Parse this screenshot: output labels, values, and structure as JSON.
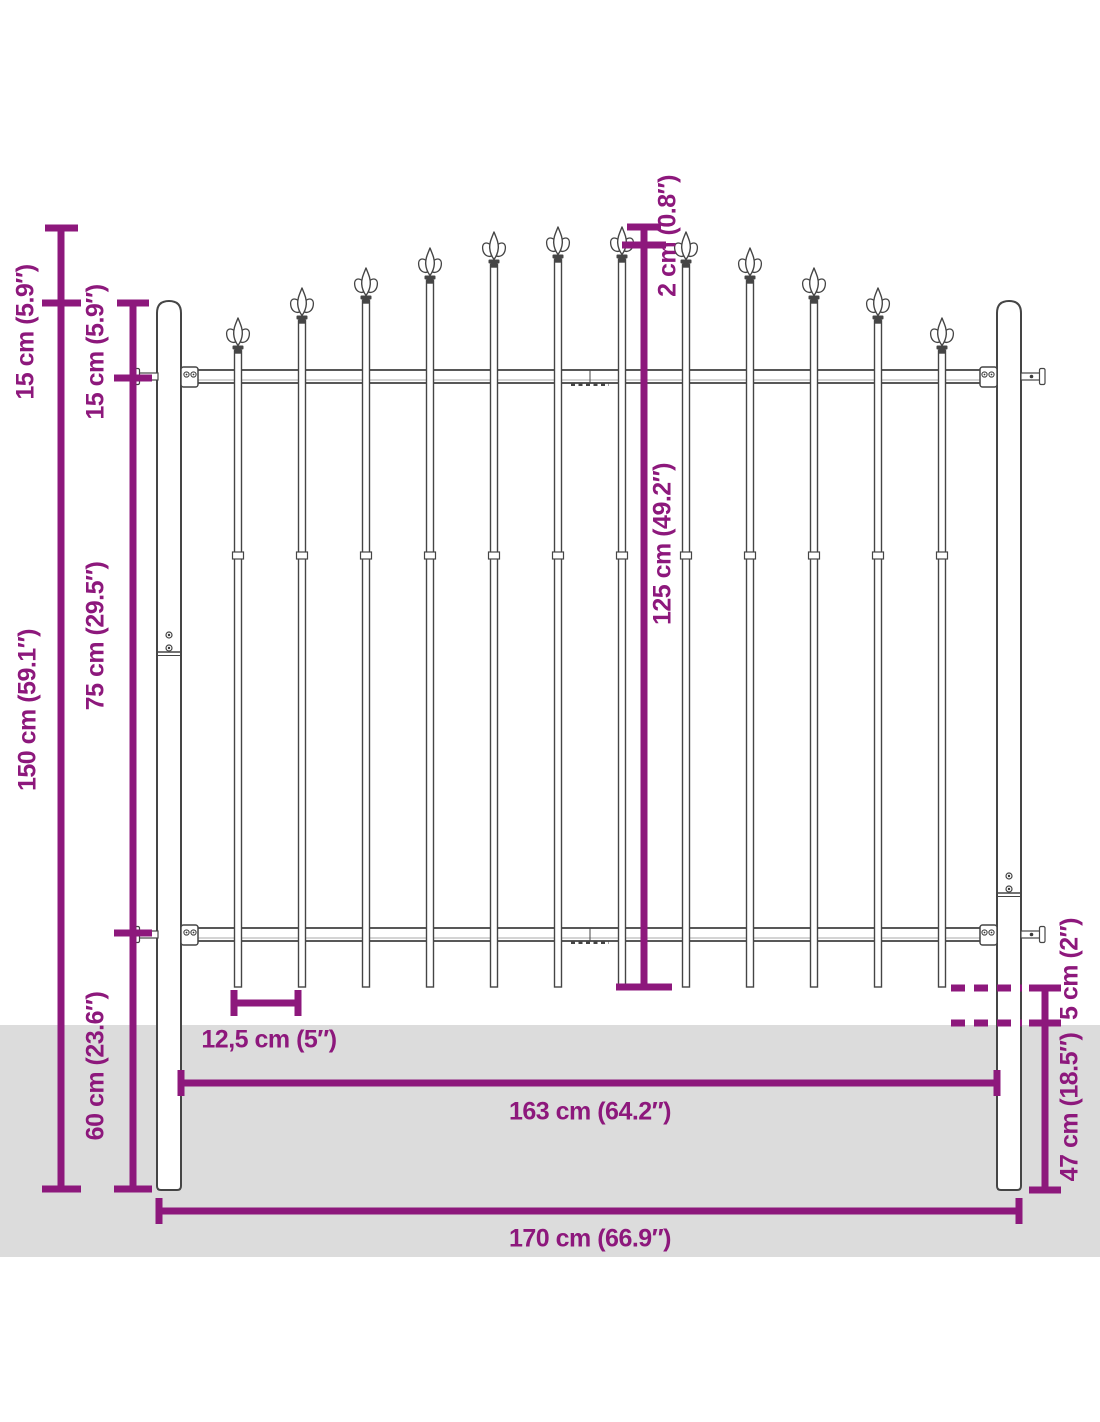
{
  "colors": {
    "dimension": "#8D187C",
    "fence_outline": "#454545",
    "fence_fill": "#ffffff",
    "rail_shade": "#aaaaaa",
    "screw_dot": "#3a3a3a",
    "ground": "#dcdcdc",
    "background": "#ffffff"
  },
  "dimensions": {
    "left_outer_15": "15 cm (5.9″)",
    "left_inner_15": "15 cm (5.9″)",
    "left_inner_75": "75 cm (29.5″)",
    "left_outer_150": "150 cm (59.1″)",
    "left_inner_60": "60 cm (23.6″)",
    "center_2": "2 cm (0.8″)",
    "center_125": "125 cm (49.2″)",
    "right_5": "5 cm (2″)",
    "right_47": "47 cm (18.5″)",
    "spacing": "12,5 cm (5″)",
    "width_inner": "163 cm (64.2″)",
    "width_outer": "170 cm (66.9″)"
  },
  "layout": {
    "labels": [
      {
        "key": "left_outer_15",
        "x": 26,
        "y": 332,
        "rot": -90
      },
      {
        "key": "left_inner_15",
        "x": 96,
        "y": 352,
        "rot": -90
      },
      {
        "key": "left_inner_75",
        "x": 96,
        "y": 636,
        "rot": -90
      },
      {
        "key": "left_outer_150",
        "x": 28,
        "y": 710,
        "rot": -90
      },
      {
        "key": "left_inner_60",
        "x": 96,
        "y": 1066,
        "rot": -90
      },
      {
        "key": "center_2",
        "x": 668,
        "y": 236,
        "rot": -90
      },
      {
        "key": "center_125",
        "x": 663,
        "y": 544,
        "rot": -90
      },
      {
        "key": "right_5",
        "x": 1070,
        "y": 969,
        "rot": -90
      },
      {
        "key": "right_47",
        "x": 1070,
        "y": 1107,
        "rot": -90
      },
      {
        "key": "spacing",
        "x": 269,
        "y": 1040,
        "rot": 0
      },
      {
        "key": "width_inner",
        "x": 590,
        "y": 1112,
        "rot": 0
      },
      {
        "key": "width_outer",
        "x": 590,
        "y": 1239,
        "rot": 0
      }
    ]
  },
  "fence": {
    "ground": {
      "y": 1025,
      "h": 232
    },
    "posts": [
      {
        "x": 157,
        "top": 301,
        "joint_y": 652,
        "screws": [
          635,
          648
        ]
      },
      {
        "x": 997,
        "top": 301,
        "joint_y": 893,
        "screws": [
          876,
          889
        ]
      }
    ],
    "post_w": 24,
    "post_bottom": 1190,
    "rails": [
      {
        "top": 370
      },
      {
        "top": 928
      }
    ],
    "rail_h": 13,
    "rail_x1": 181,
    "rail_x2": 997,
    "seam_x": 590,
    "pickets": {
      "xs": [
        238,
        302,
        366,
        430,
        494,
        558,
        622,
        686,
        750,
        814,
        878,
        942
      ],
      "tips": [
        318,
        288,
        268,
        248,
        232,
        227,
        227,
        232,
        248,
        268,
        288,
        318
      ],
      "bottom": 987,
      "w": 7,
      "sleeve_y": 552
    }
  },
  "dim_geometry": {
    "stroke": 7,
    "vlines": [
      {
        "x": 61,
        "y1": 228,
        "y2": 1189,
        "ticks": [
          {
            "y": 228,
            "x1": 45,
            "x2": 78
          },
          {
            "y": 303,
            "x1": 42,
            "x2": 81
          },
          {
            "y": 1189,
            "x1": 42,
            "x2": 81
          }
        ]
      },
      {
        "x": 133,
        "y1": 303,
        "y2": 1189,
        "ticks": [
          {
            "y": 303,
            "x1": 117,
            "x2": 149
          },
          {
            "y": 378,
            "x1": 114,
            "x2": 152
          },
          {
            "y": 933,
            "x1": 114,
            "x2": 152
          },
          {
            "y": 1189,
            "x1": 114,
            "x2": 152
          }
        ]
      },
      {
        "x": 644,
        "y1": 227,
        "y2": 987,
        "ticks": [
          {
            "y": 227,
            "x1": 627,
            "x2": 661
          },
          {
            "y": 245,
            "x1": 622,
            "x2": 666
          },
          {
            "y": 987,
            "x1": 616,
            "x2": 672
          }
        ]
      },
      {
        "x": 1045,
        "y1": 988,
        "y2": 1190,
        "ticks": [
          {
            "y": 988,
            "x1": 1029,
            "x2": 1061
          },
          {
            "y": 1023,
            "x1": 1029,
            "x2": 1061
          },
          {
            "y": 1190,
            "x1": 1029,
            "x2": 1061
          }
        ]
      }
    ],
    "hlines": [
      {
        "y": 1003,
        "x1": 234,
        "x2": 298,
        "ticks": [
          {
            "x": 234,
            "y1": 990,
            "y2": 1016
          },
          {
            "x": 298,
            "y1": 990,
            "y2": 1016
          }
        ]
      },
      {
        "y": 1083,
        "x1": 181,
        "x2": 997,
        "ticks": [
          {
            "x": 181,
            "y1": 1070,
            "y2": 1096
          },
          {
            "x": 997,
            "y1": 1070,
            "y2": 1096
          }
        ]
      },
      {
        "y": 1211,
        "x1": 159,
        "x2": 1019,
        "ticks": [
          {
            "x": 159,
            "y1": 1198,
            "y2": 1224
          },
          {
            "x": 1019,
            "y1": 1198,
            "y2": 1224
          }
        ]
      }
    ],
    "dashed": [
      {
        "y": 988,
        "x1": 951,
        "x2": 1022
      },
      {
        "y": 1023,
        "x1": 951,
        "x2": 1022
      }
    ]
  }
}
